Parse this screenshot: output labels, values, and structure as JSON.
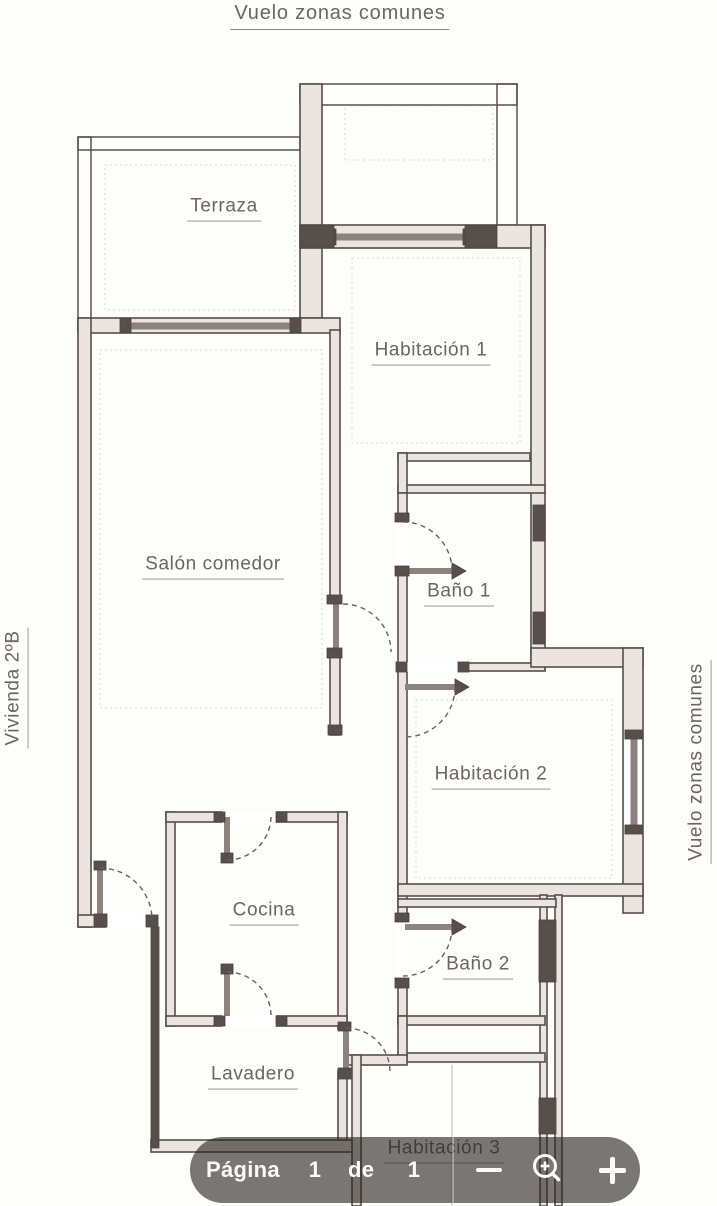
{
  "page": {
    "top_label": "Vuelo zonas comunes",
    "left_label": "Vivienda 2ºB",
    "right_label": "Vuelo zonas comunes"
  },
  "plan": {
    "rooms": [
      {
        "name": "Terraza"
      },
      {
        "name": "Habitación 1"
      },
      {
        "name": "Salón comedor"
      },
      {
        "name": "Baño 1"
      },
      {
        "name": "Habitación 2"
      },
      {
        "name": "Cocina"
      },
      {
        "name": "Baño 2"
      },
      {
        "name": "Lavadero"
      },
      {
        "name": "Habitación 3"
      }
    ]
  },
  "toolbar": {
    "page_label": "Página",
    "current_page": "1",
    "of_label": "de",
    "total_pages": "1",
    "icons": {
      "zoom_out": "minus-icon",
      "zoom": "magnifier-plus-icon",
      "zoom_in": "plus-icon"
    }
  },
  "colors": {
    "plan_line": "#564e4a",
    "wall_fill": "#eae5e0",
    "wall_dark": "#574f4b",
    "window_band": "#8d837e",
    "label_text": "#6e6462",
    "toolbar_bg": "rgba(42,35,32,0.62)",
    "toolbar_fg": "#fbfaf9"
  }
}
